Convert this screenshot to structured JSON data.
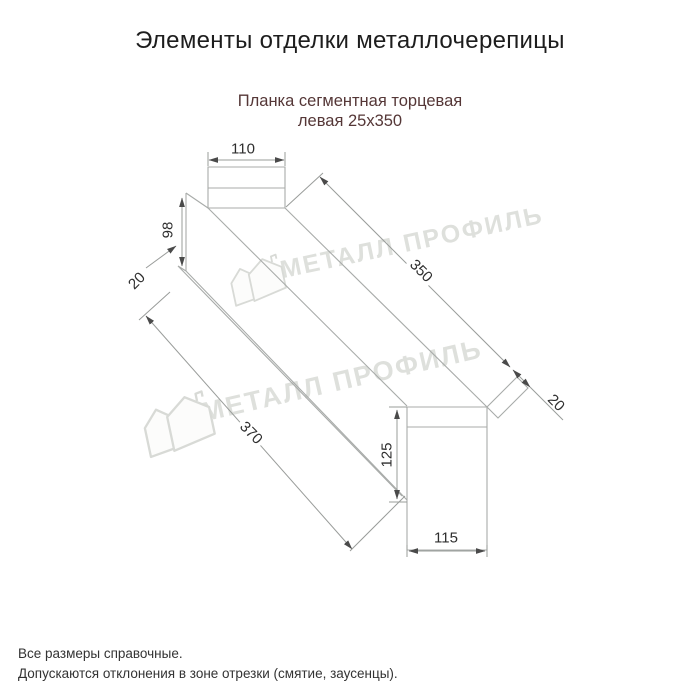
{
  "header": {
    "title": "Элементы отделки металлочерепицы"
  },
  "product": {
    "subtitle_line1": "Планка сегментная торцевая",
    "subtitle_line2": "левая 25х350"
  },
  "drawing": {
    "type": "technical-drawing",
    "dims": {
      "top_width": "110",
      "left_height": "98",
      "left_hem": "20",
      "overall_length": "370",
      "face_length": "350",
      "end_flap": "20",
      "right_height": "125",
      "right_width": "115"
    },
    "edge_color": "#a8aba9",
    "dim_line_color": "#999c9a",
    "arrow_color": "#4a4a4a"
  },
  "watermark": {
    "text": "МЕТАЛЛ ПРОФИЛЬ",
    "color": "#d9dbd7"
  },
  "footer": {
    "note1": "Все размеры справочные.",
    "note2": "Допускаются отклонения в зоне отрезки (смятие, заусенцы)."
  }
}
